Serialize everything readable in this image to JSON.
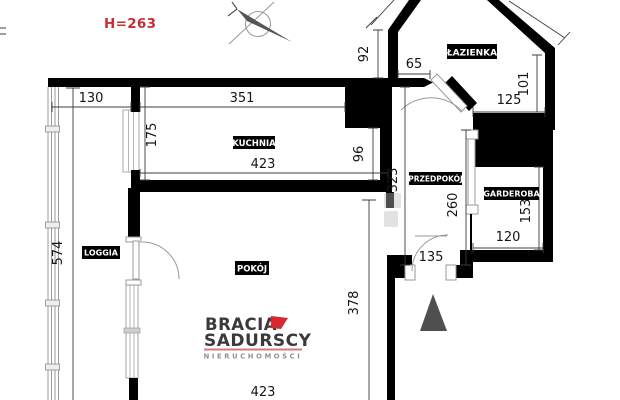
{
  "note": {
    "text": "H=263",
    "color": "#c62f2f"
  },
  "rooms": {
    "kuchnia": "KUCHNIA",
    "lazienka": "ŁAZIENKA",
    "przedpokoj": "PRZEDPOKÓJ",
    "garderoba": "GARDEROBA",
    "loggia": "LOGGIA",
    "pokoj": "POKÓJ"
  },
  "dims": {
    "loggia_width": "130",
    "kuchnia_top_width": "351",
    "kuchnia_left_height": "175",
    "kuchnia_bottom_width": "423",
    "bath_left_height": "92",
    "bath_door_wall": "65",
    "kuchnia_right_height": "96",
    "przedpokoj_height": "323",
    "bath_right_height": "101",
    "bath_bottom_width": "125",
    "przedpokoj_right_height": "260",
    "garderoba_right_height": "153",
    "garderoba_bottom_width": "120",
    "entry_door_width": "135",
    "loggia_height": "574",
    "pokoj_right_height": "378",
    "pokoj_bottom_width": "423"
  },
  "logo": {
    "line1": "BRACIA",
    "line2": "SADURSCY",
    "tagline": "NIERUCHOMOŚCI",
    "dark": "#3a3a3c",
    "red": "#d7282f",
    "underline": "#d4797e",
    "gray": "#8f9196"
  },
  "icons": {
    "compass": "compass-needle-icon",
    "entrance_marker": "entrance-triangle-marker"
  },
  "colors": {
    "wall": "#000000",
    "dimension": "#3c3c3c",
    "triangle": "#4f4f4f"
  }
}
